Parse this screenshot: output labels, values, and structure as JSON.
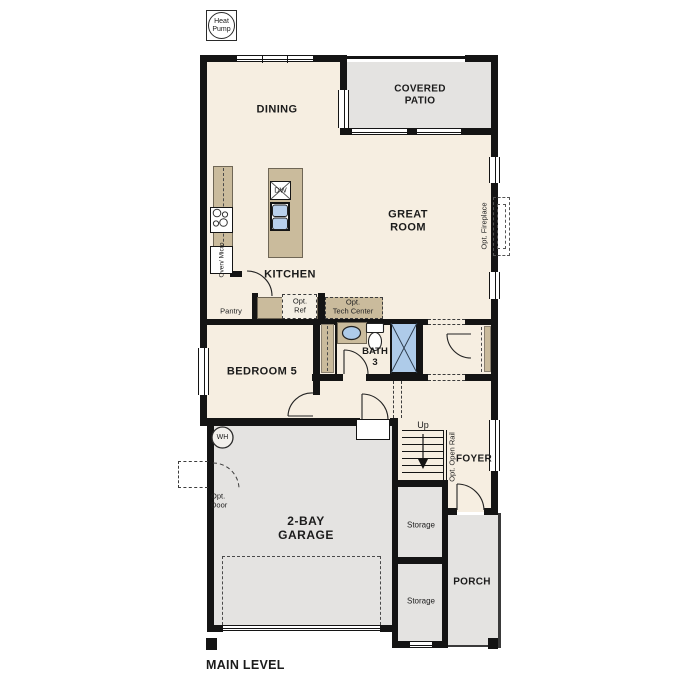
{
  "title": {
    "main_level": "MAIN LEVEL"
  },
  "rooms": {
    "dining": "DINING",
    "covered_patio": "COVERED\nPATIO",
    "great_room": "GREAT\nROOM",
    "kitchen": "KITCHEN",
    "bedroom5": "BEDROOM 5",
    "bath3": "BATH\n3",
    "garage": "2-BAY\nGARAGE",
    "foyer": "FOYER",
    "porch": "PORCH",
    "storage_upper": "Storage",
    "storage_lower": "Storage"
  },
  "features": {
    "pantry": "Pantry",
    "opt_ref": "Opt.\nRef",
    "opt_tech_center": "Opt.\nTech Center",
    "opt_fireplace": "Opt. Fireplace",
    "opt_open_rail": "Opt. Open Rail",
    "opt_door": "Opt.\nDoor",
    "up": "Up",
    "dw": "DW",
    "wh": "WH",
    "oven_micro": "Oven/\nMicro",
    "heat_pump": "Heat\nPump"
  },
  "colors": {
    "wall": "#141414",
    "floor": "#f6eee1",
    "outdoor": "#e4e3e1",
    "counter": "#cabb9c",
    "fixture_blue": "#aecbe9"
  }
}
